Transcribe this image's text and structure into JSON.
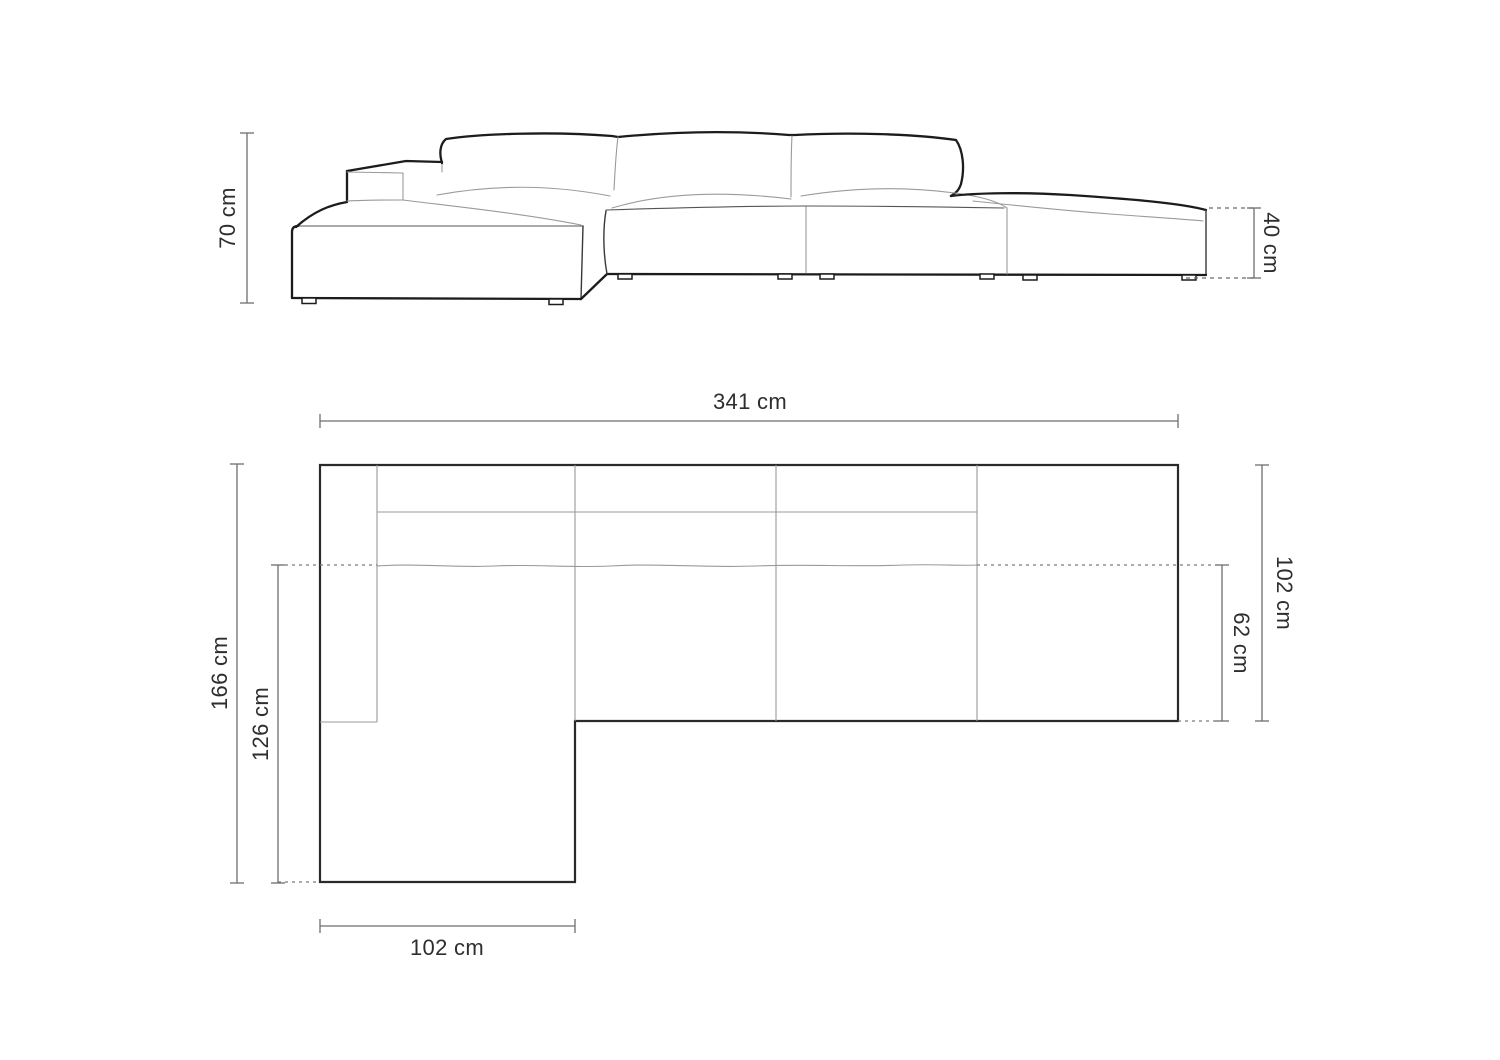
{
  "elevation": {
    "height_label": "70 cm",
    "seat_height_label": "40 cm"
  },
  "plan": {
    "total_width_label": "341 cm",
    "total_depth_label": "166 cm",
    "chaise_inner_depth_label": "126 cm",
    "body_depth_label": "102 cm",
    "seat_depth_label": "62 cm",
    "chaise_width_label": "102 cm"
  },
  "colors": {
    "outline": "#1c1c1c",
    "detail": "#9a9a9a",
    "dimension": "#6e6e6e",
    "text": "#2e2e2e",
    "background": "#ffffff"
  }
}
